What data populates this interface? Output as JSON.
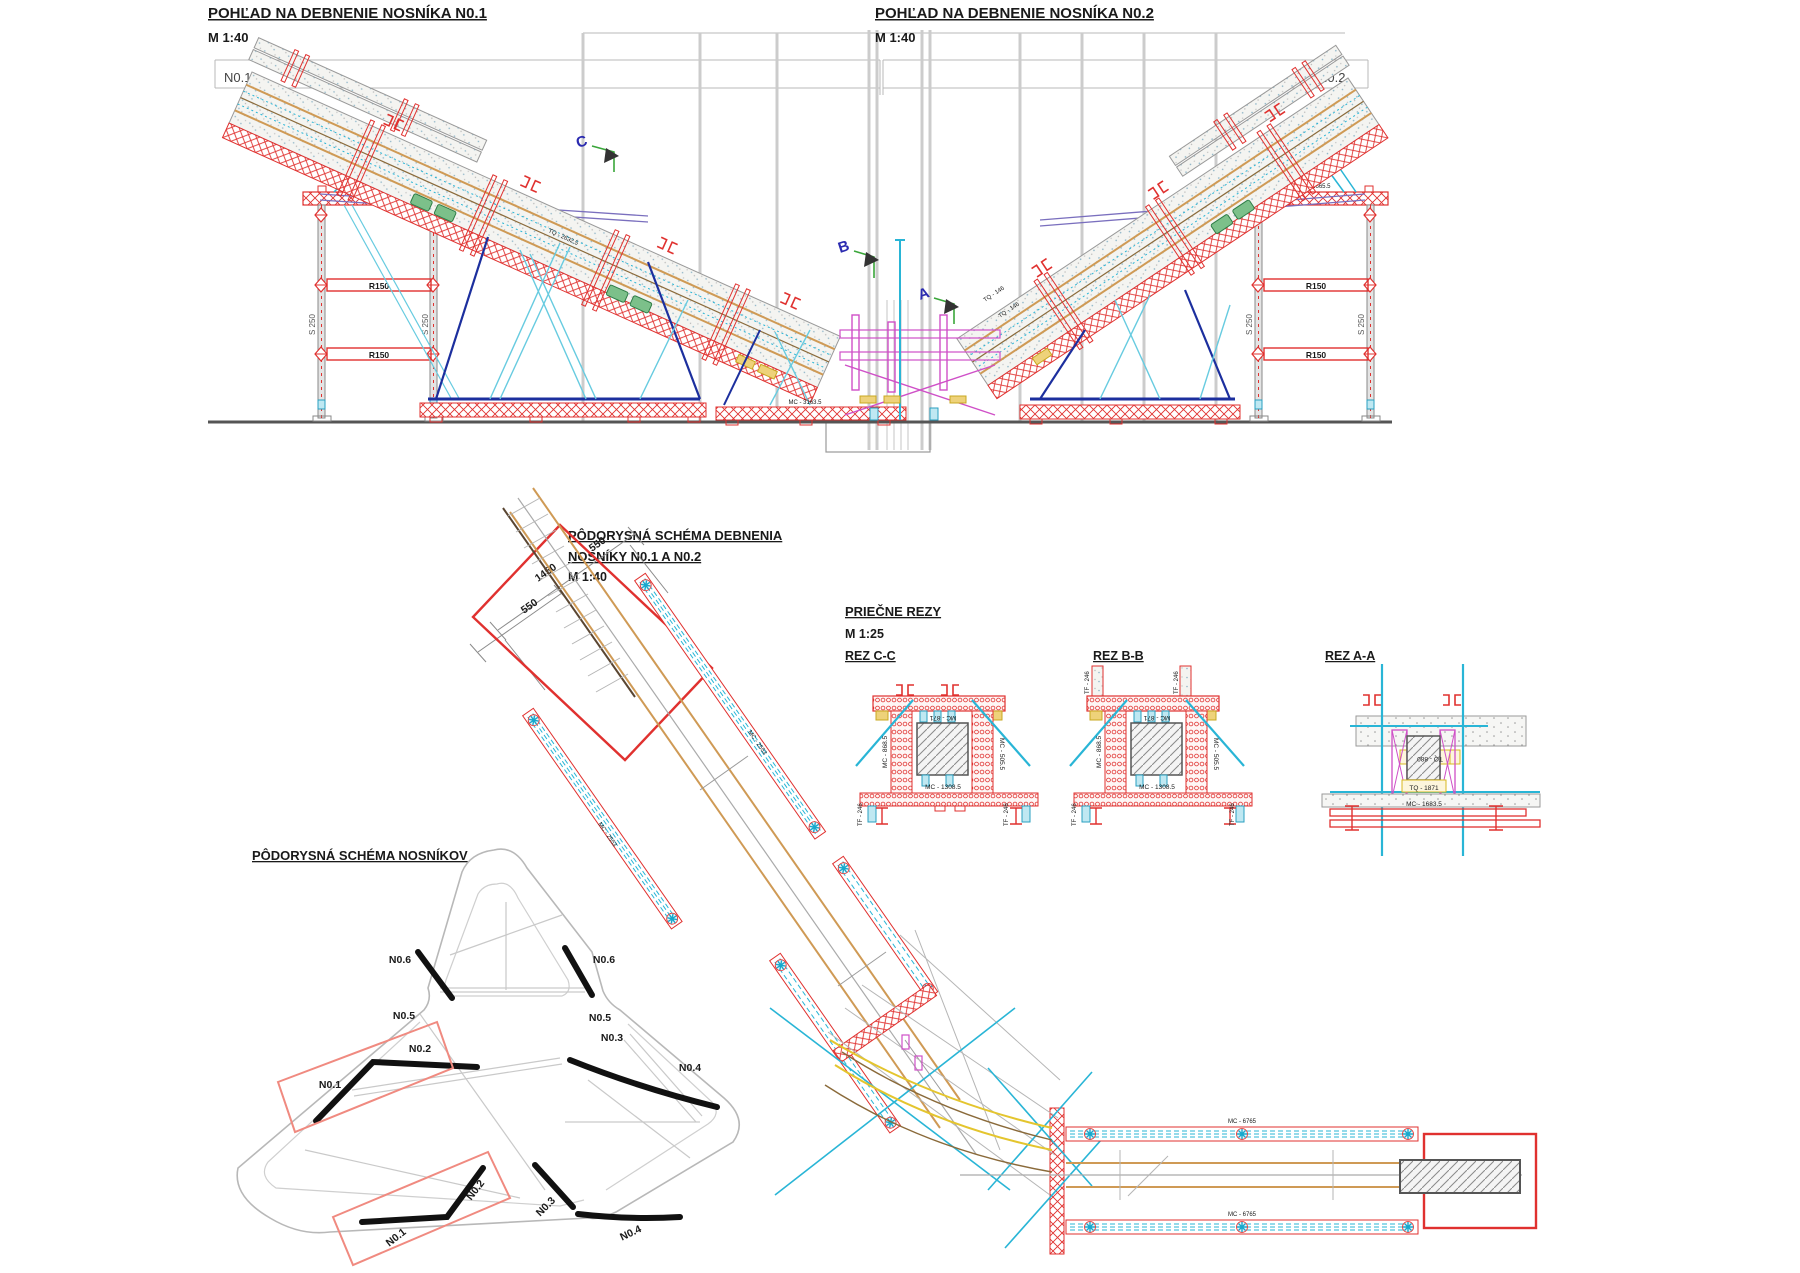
{
  "header": {
    "elev1_title": "POHĽAD NA DEBNENIE NOSNÍKA N0.1",
    "elev1_scale": "M 1:40",
    "elev2_title": "POHĽAD NA DEBNENIE NOSNÍKA N0.2",
    "elev2_scale": "M 1:40"
  },
  "elevation": {
    "axis_left": "N0.1",
    "axis_right": "N0.2",
    "r150": "R150",
    "s250": "S 250",
    "cap_label": "MC - 1665.5",
    "beam_label": "TQ - 2632.5",
    "base_label": "MC - 3163.5",
    "node_label": "TQ - 146",
    "marker_a": "A",
    "marker_b": "B",
    "marker_c": "C"
  },
  "plan_formwork": {
    "title_line1": "PÔDORYSNÁ SCHÉMA DEBNENIA",
    "title_line2": "NOSNÍKY N0.1 A N0.2",
    "scale": "M 1:40",
    "dim_550_left": "550",
    "dim_1450": "1450",
    "dim_550_right": "550",
    "rail_label": "MC - 2553",
    "chord_label": "MC - 6765"
  },
  "sections": {
    "group_title": "PRIEČNE REZY",
    "scale": "M 1:25",
    "rez_cc": "REZ C-C",
    "rez_bb": "REZ B-B",
    "rez_aa": "REZ A-A",
    "mc_871": "MC - 871",
    "mc_1308_5": "MC - 1308.5",
    "mc_868_5": "MC - 868.5",
    "mc_505_5": "MC - 505.5",
    "tf_246": "TF - 246",
    "tq_880": "TQ - 880",
    "tq_1871": "TQ - 1871",
    "mc_1683_5": "MC - 1683.5"
  },
  "plan_beams": {
    "title": "PÔDORYSNÁ SCHÉMA NOSNÍKOV"
  },
  "beam_labels": {
    "n01": "N0.1",
    "n02": "N0.2",
    "n03": "N0.3",
    "n04": "N0.4",
    "n05": "N0.5",
    "n06": "N0.6"
  },
  "colors": {
    "formwork_red": "#e0312f",
    "magenta": "#cf4fc7",
    "cyan": "#29b5d6",
    "dark_blue": "#1c2f9e",
    "green": "#3aa63a",
    "orange": "#cf9a55",
    "purple": "#7a6fbe",
    "yellow": "#e4c52e",
    "concrete_gray": "#9a9a9a"
  }
}
